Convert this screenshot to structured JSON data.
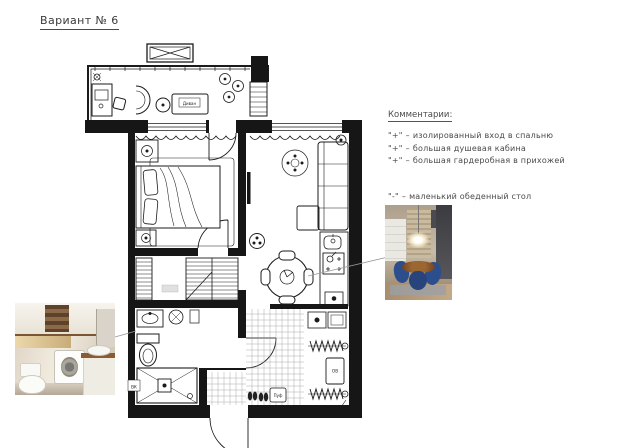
{
  "title": "Вариант № 6",
  "comments": {
    "heading": "Комментарии:",
    "separator": "–",
    "items": [
      {
        "mark": "\"+\"",
        "text": "изолированный вход в спальню",
        "type": "pro"
      },
      {
        "mark": "\"+\"",
        "text": "большая душевая кабина",
        "type": "pro"
      },
      {
        "mark": "\"+\"",
        "text": "большая гардеробная в прихожей",
        "type": "pro"
      },
      {
        "mark": "\"-\"",
        "text": "маленький обеденный стол",
        "type": "con"
      }
    ]
  },
  "plan": {
    "labels": {
      "sofa": "Диван",
      "pouf": "Пуф",
      "vent": "ВК",
      "heater": "ОВ"
    }
  },
  "colors": {
    "wall": "#161616",
    "line": "#1b1b1b",
    "leader": "#999999",
    "photo_accent_blue": "#2c4e8c",
    "photo_wood": "#8a5c34"
  }
}
